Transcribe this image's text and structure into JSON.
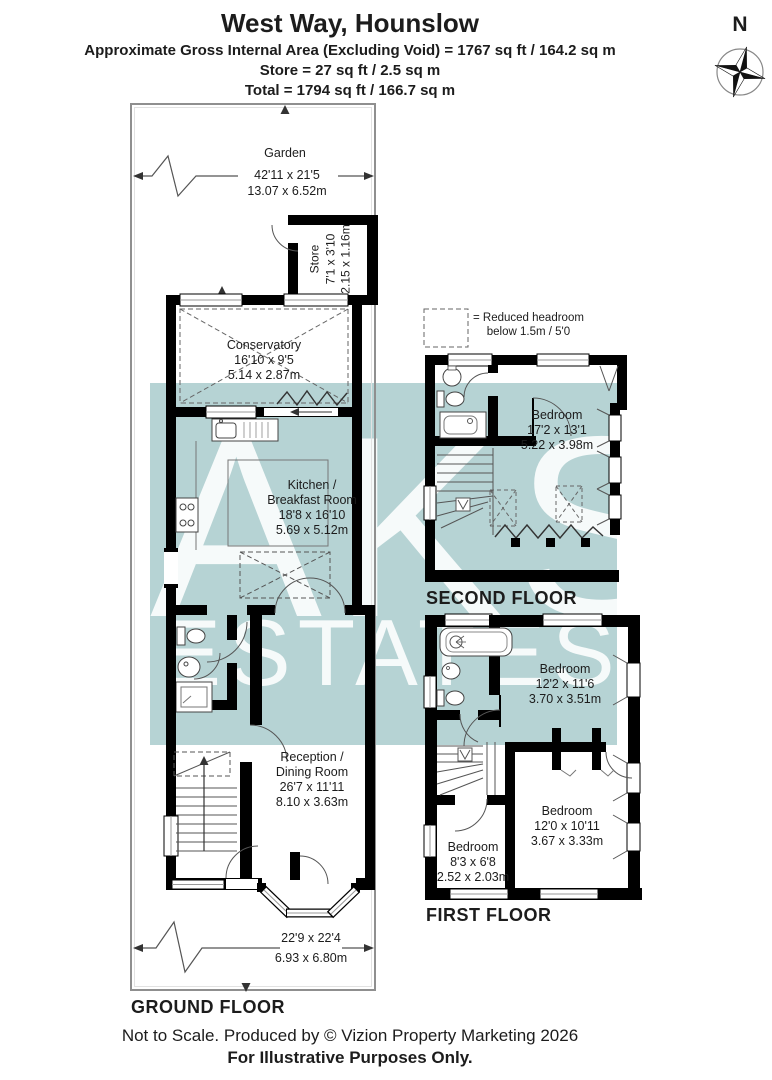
{
  "header": {
    "title": "West Way, Hounslow",
    "line1": "Approximate Gross Internal Area (Excluding Void) = 1767 sq ft / 164.2 sq m",
    "line2": "Store = 27 sq ft / 2.5 sq m",
    "line3": "Total = 1794 sq ft / 166.7 sq m"
  },
  "compass": {
    "north_label": "N"
  },
  "watermark": {
    "line1": "AKS",
    "line2": "ESTATES"
  },
  "legend": {
    "line1": "= Reduced headroom",
    "line2": "below 1.5m / 5'0"
  },
  "ground_floor": {
    "label": "GROUND FLOOR",
    "garden": {
      "name": "Garden",
      "imperial": "42'11 x 21'5",
      "metric": "13.07 x 6.52m"
    },
    "store": {
      "name": "Store",
      "imperial": "7'1 x 3'10",
      "metric": "2.15 x 1.16m"
    },
    "conservatory": {
      "name": "Conservatory",
      "imperial": "16'10 x 9'5",
      "metric": "5.14 x 2.87m"
    },
    "kitchen": {
      "name_line1": "Kitchen /",
      "name_line2": "Breakfast Room",
      "imperial": "18'8 x 16'10",
      "metric": "5.69 x 5.12m"
    },
    "reception": {
      "name_line1": "Reception /",
      "name_line2": "Dining Room",
      "imperial": "26'7 x 11'11",
      "metric": "8.10 x 3.63m"
    },
    "front_garden": {
      "imperial": "22'9 x 22'4",
      "metric": "6.93 x 6.80m"
    }
  },
  "second_floor": {
    "label": "SECOND FLOOR",
    "bedroom": {
      "name": "Bedroom",
      "imperial": "17'2 x 13'1",
      "metric": "5.22 x 3.98m"
    }
  },
  "first_floor": {
    "label": "FIRST FLOOR",
    "bedroom_front": {
      "name": "Bedroom",
      "imperial": "12'2 x 11'6",
      "metric": "3.70 x 3.51m"
    },
    "bedroom_middle": {
      "name": "Bedroom",
      "imperial": "12'0 x 10'11",
      "metric": "3.67 x 3.33m"
    },
    "bedroom_small": {
      "name": "Bedroom",
      "imperial": "8'3 x 6'8",
      "metric": "2.52 x 2.03m"
    }
  },
  "footer": {
    "line1": "Not to Scale. Produced by © Vizion Property Marketing 2026",
    "line2": "For Illustrative Purposes Only."
  },
  "colors": {
    "watermark_band": "#b6d3d4",
    "wall": "#000000",
    "boundary": "#8f8f8f"
  }
}
